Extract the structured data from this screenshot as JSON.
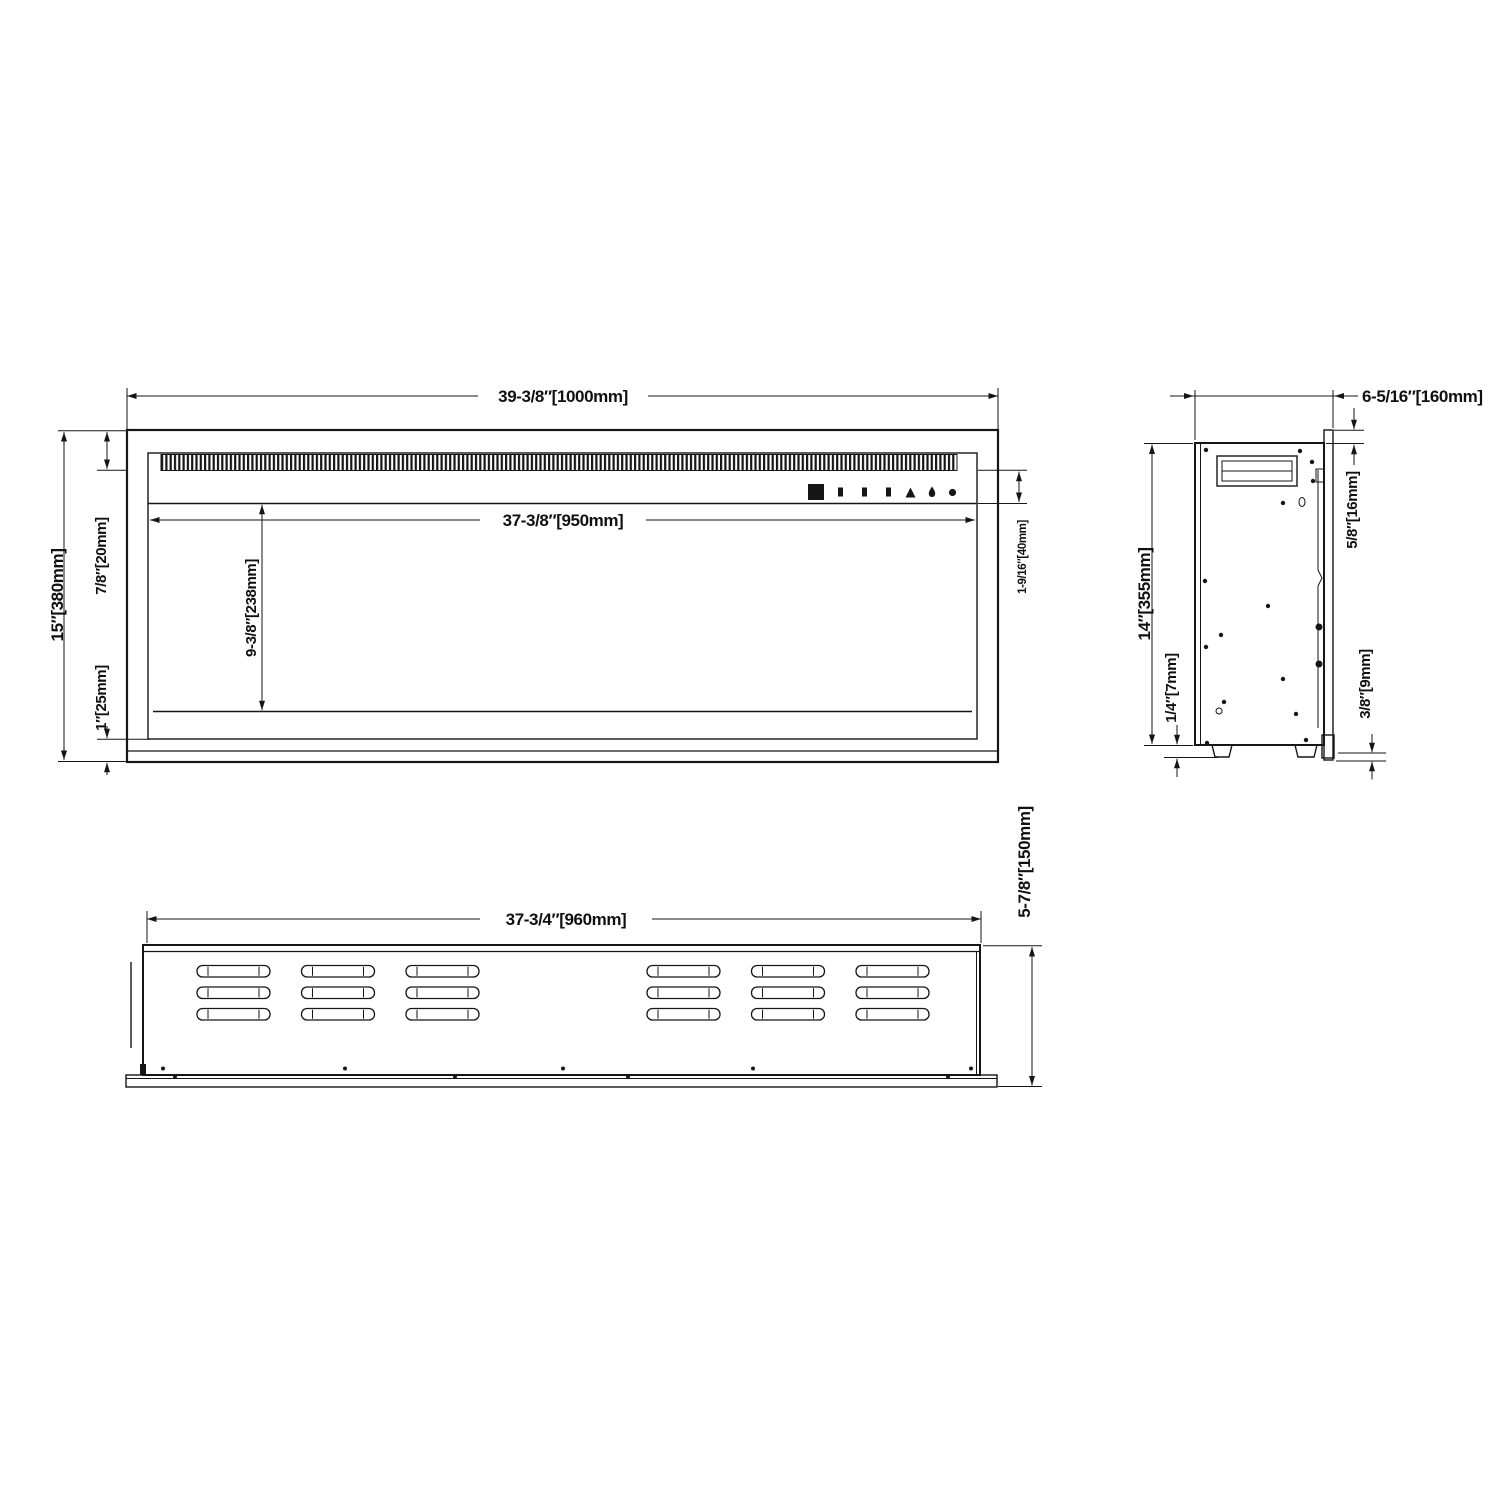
{
  "drawing": {
    "type": "three-view technical dimension drawing of wall-insert electric fireplace",
    "background_color": "#ffffff",
    "line_color": "#161616",
    "front_view": {
      "overall_width": "39-3/8″[1000mm]",
      "opening_width": "37-3/8″[950mm]",
      "overall_height": "15″[380mm]",
      "vent_band_height": "7/8″[20mm]",
      "opening_height": "9-3/8″[238mm]",
      "bottom_frame_height": "1″[25mm]",
      "control_strip_height": "1-9/16″[40mm]",
      "control_icons": [
        "display-window",
        "button",
        "button",
        "button",
        "flame-button",
        "drop-button",
        "power-button"
      ]
    },
    "side_view": {
      "overall_depth": "6-5/16″[160mm]",
      "flange_top_overhang": "5/8″[16mm]",
      "body_height": "14″[355mm]",
      "foot_height": "1/4″[7mm]",
      "flange_bottom_overhang": "3/8″[9mm]"
    },
    "bottom_view": {
      "body_width": "37-3/4″[960mm]",
      "overall_depth": "5-7/8″[150mm]",
      "louver_groups": 2,
      "louver_columns_per_group": 3,
      "louver_rows": 3
    }
  }
}
